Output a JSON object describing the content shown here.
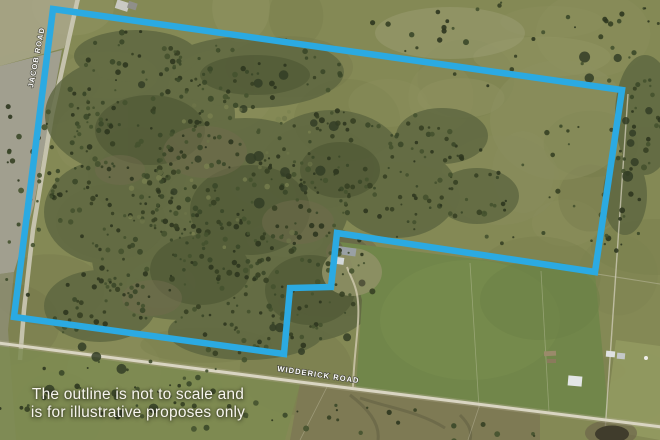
{
  "image": {
    "description": "aerial satellite photo of rural acreage with property boundary overlay",
    "outline_color": "#2BAAE2",
    "outline_stroke_width": 6.5,
    "outline_points": [
      [
        53,
        9
      ],
      [
        622,
        90
      ],
      [
        595,
        272
      ],
      [
        337,
        233
      ],
      [
        331,
        287
      ],
      [
        290,
        288
      ],
      [
        284,
        354
      ],
      [
        14,
        317
      ]
    ]
  },
  "roads": {
    "jacob": "JACOB ROAD",
    "widderick": "WIDDERICK ROAD"
  },
  "caption": {
    "line1": "The outline is not to scale and",
    "line2": "is for illustrative proposes only"
  }
}
